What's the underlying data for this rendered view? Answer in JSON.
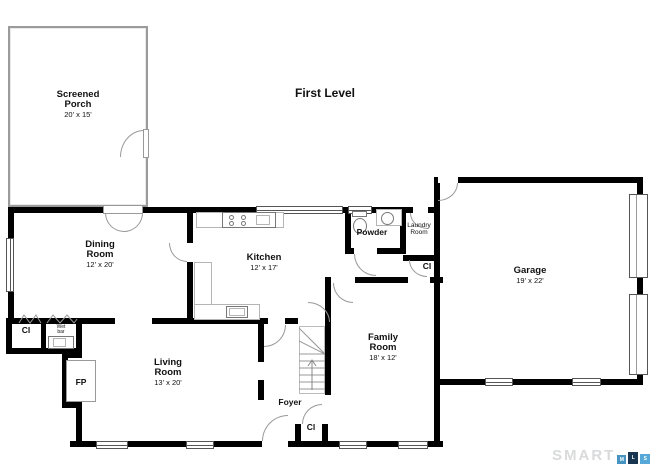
{
  "title": "First Level",
  "rooms": {
    "screened_porch": {
      "name": "Screened Porch",
      "dims": "20' x 15'"
    },
    "dining": {
      "name": "Dining Room",
      "dims": "12' x 20'"
    },
    "kitchen": {
      "name": "Kitchen",
      "dims": "12' x 17'"
    },
    "powder": {
      "name": "Powder"
    },
    "laundry": {
      "name": "Laundry Room"
    },
    "garage": {
      "name": "Garage",
      "dims": "19' x 22'"
    },
    "family": {
      "name": "Family Room",
      "dims": "18' x 12'"
    },
    "living": {
      "name": "Living Room",
      "dims": "13' x 20'"
    },
    "foyer": {
      "name": "Foyer"
    }
  },
  "labels": {
    "closet": "Cl",
    "fireplace": "FP",
    "wet_bar": "Wet bar"
  },
  "logo": {
    "brand": "SMART",
    "squares": [
      {
        "letter": "M",
        "color": "#4793c2"
      },
      {
        "letter": "L",
        "color": "#173450"
      },
      {
        "letter": "S",
        "color": "#55a8d8"
      }
    ]
  },
  "colors": {
    "walls": "#000000",
    "porch_wall": "#9b9b9b",
    "door_arc": "#999999",
    "logo_gray": "#d9dadb"
  }
}
